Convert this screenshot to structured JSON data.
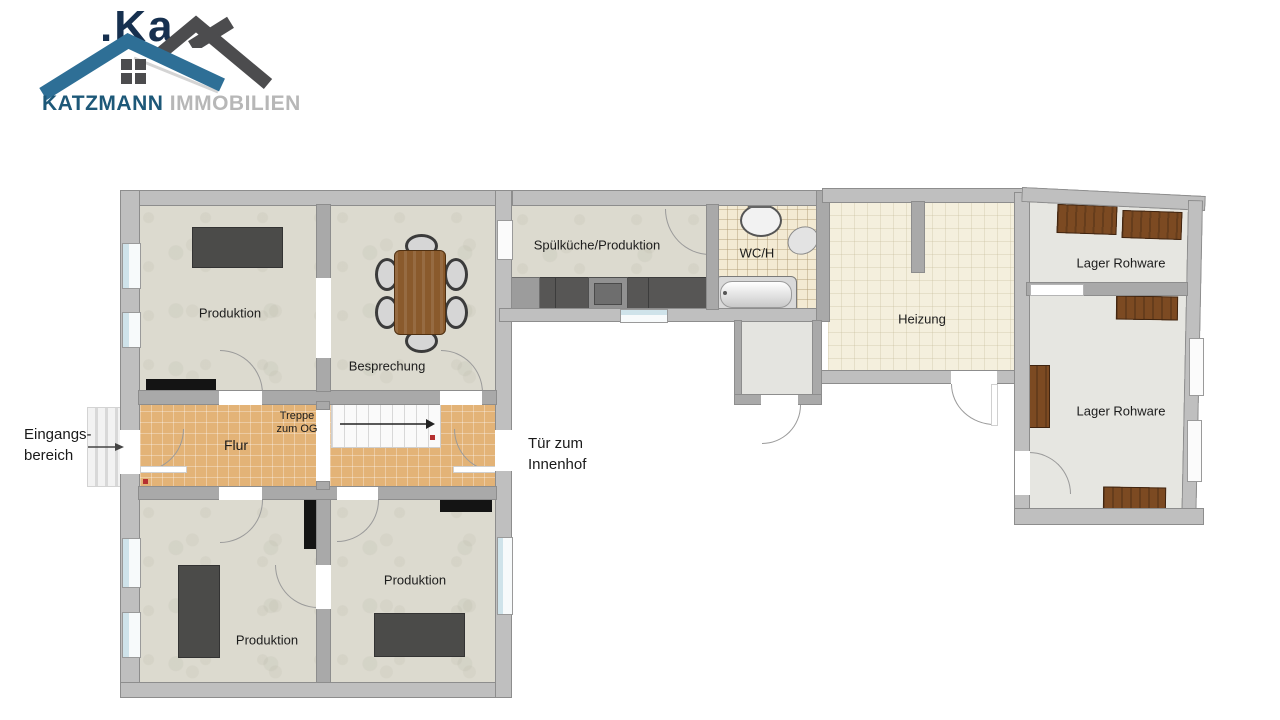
{
  "logo": {
    "brand": "KATZMANN",
    "brand_suffix": "IMMOBILIEN",
    "watermark_fragment": ".Ka",
    "colors": {
      "roof_blue": "#2e6f96",
      "roof_dark": "#4c4c4e",
      "brand": "#1d5878",
      "suffix": "#b7b7b7"
    }
  },
  "floorplan": {
    "rooms": {
      "produktion_nw": "Produktion",
      "besprechung": "Besprechung",
      "spuelkueche": "Spülküche/Produktion",
      "wc": "WC/H",
      "heizung": "Heizung",
      "lager_1": "Lager Rohware",
      "lager_2": "Lager Rohware",
      "flur": "Flur",
      "produktion_sw": "Produktion",
      "produktion_s": "Produktion"
    },
    "annotations": {
      "treppe_line1": "Treppe",
      "treppe_line2": "zum OG",
      "eingang_line1": "Eingangs-",
      "eingang_line2": "bereich",
      "innenhof_line1": "Tür zum",
      "innenhof_line2": "Innenhof"
    },
    "colors": {
      "wall": "#a9a9a9",
      "outer_wall": "#bfbfbf",
      "floor_marble": "#dcdacf",
      "floor_tile_orange": "#e3b377",
      "floor_cream": "#f4efdd",
      "floor_wc_tile": "#f3ead3",
      "floor_lager": "#e6e6e1",
      "furniture_dark": "#4b4b49",
      "table_wood": "#8a5a2c",
      "shelf_wood": "#7c4a22",
      "counter": "#575655",
      "window_glass": "#cfe3ea"
    }
  }
}
